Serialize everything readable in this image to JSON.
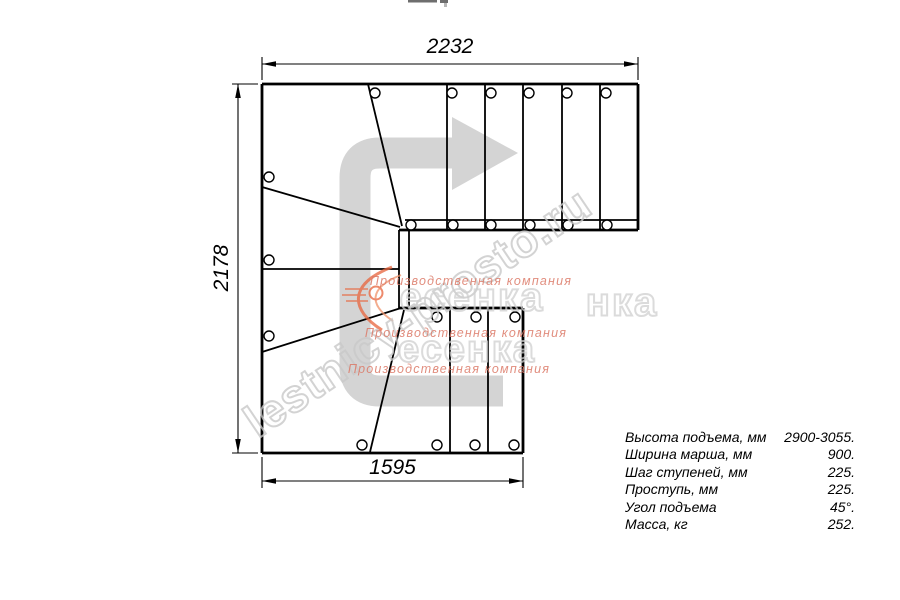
{
  "dimensions": {
    "top": "2232",
    "left": "2178",
    "bottom": "1595"
  },
  "specs": {
    "rows": [
      {
        "label": "Высота подъема, мм",
        "value": "2900-3055."
      },
      {
        "label": "Ширина марша, мм",
        "value": "900."
      },
      {
        "label": "Шаг ступеней, мм",
        "value": "225."
      },
      {
        "label": "Проступь, мм",
        "value": "225."
      },
      {
        "label": "Угол подъема",
        "value": "45°."
      },
      {
        "label": "Масса, кг",
        "value": "252."
      }
    ]
  },
  "watermarks": {
    "site": "lestnicy-prosto.ru",
    "logo_text": "есенка",
    "logo_text_partial": "нка",
    "slogan": "Производственная компания"
  },
  "colors": {
    "line": "#000000",
    "arrow_gray": "#d4d4d4",
    "watermark_gray": "#c9c9c9",
    "slogan_red": "#dc7a68",
    "swoosh_orange": "#e8643c"
  }
}
